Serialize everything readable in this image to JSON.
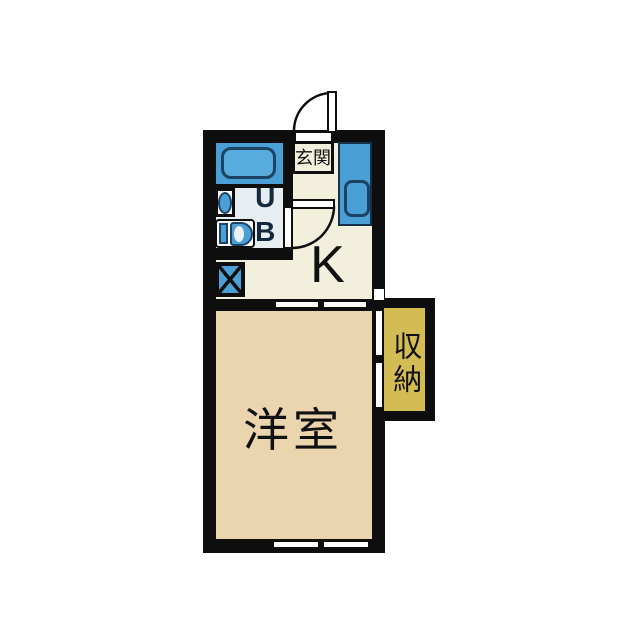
{
  "floor_plan": {
    "type": "japanese-apartment-floorplan",
    "labels": {
      "entrance": "玄関",
      "unit_bath": "UB",
      "kitchen": "K",
      "western_room": "洋室",
      "closet": "収納"
    },
    "rooms": [
      {
        "id": "entrance",
        "label": "玄関"
      },
      {
        "id": "unit_bath",
        "label": "UB"
      },
      {
        "id": "kitchen",
        "label": "K"
      },
      {
        "id": "western_room",
        "label": "洋室"
      },
      {
        "id": "closet",
        "label": "収納"
      }
    ],
    "fixtures": [
      "bathtub-icon",
      "washbasin-icon",
      "toilet-icon",
      "kitchen-sink-icon",
      "washing-machine-space-icon",
      "entrance-door-swing-icon",
      "bath-door-swing-icon",
      "sliding-door-2panel",
      "window-2panel",
      "closet-sliding-door-2panel"
    ],
    "colors": {
      "background": "#ffffff",
      "wall": "#0e0e0e",
      "kitchen_floor": "#f2efdd",
      "western_room_floor": "#ebd5ae",
      "unit_bath_floor": "#e7eef2",
      "closet_fill": "#d4bc55",
      "fixture_blue": "#4aa0d5",
      "bathtub_blue": "#58abdd",
      "fixture_outline": "#1d4263",
      "label_text": "#111111",
      "ub_label_text": "#14283f"
    }
  }
}
